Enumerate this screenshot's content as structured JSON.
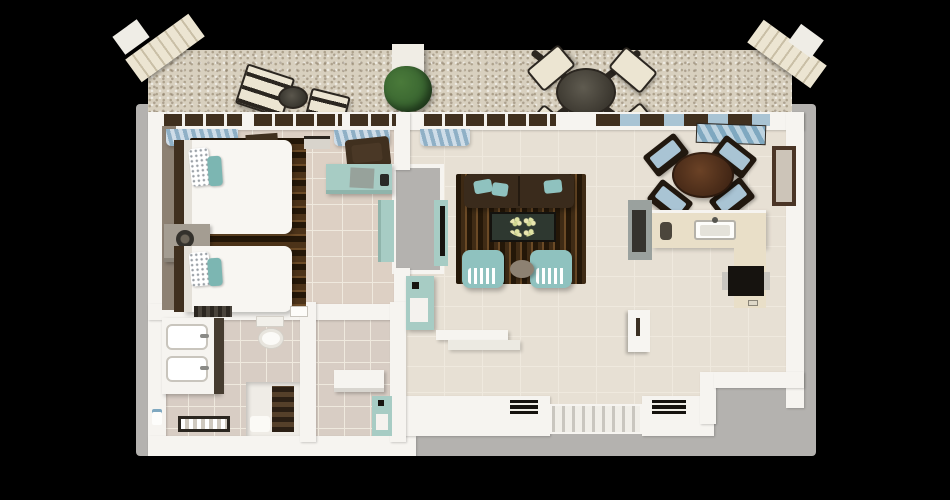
{
  "scene": {
    "title": "3D top-view floor plan render of a one-bedroom apartment with balcony",
    "view": "top-down 3d render",
    "background": "black"
  },
  "colors": {
    "background": "#000000",
    "exterior_concrete": "#b4b2af",
    "balcony_pebble": "#d8d0bf",
    "wall": "#f6f4f0",
    "floor_tile": "#e7e0d4",
    "floor_grout": "#efe9de",
    "bedroom_floor": "#ddd0c4",
    "bath_floor": "#d8cdc4",
    "taupe_wall": "#8d8173",
    "rug_dark": "#241708",
    "rug_mid": "#4c3319",
    "rug_light": "#6b4a26",
    "sofa_brown": "#3a2b1c",
    "teal": "#8fc2bf",
    "teal_deep": "#7cb6b2",
    "mint": "#a7ccc4",
    "wood_dark": "#40301f",
    "walnut": "#6b4226",
    "glass_blue": "#a9c4d4",
    "curtain_blue": "#8fb0c6",
    "curtain_light": "#cfdde8",
    "cream": "#ece5d2",
    "frame_black": "#2b2620",
    "plant_green": "#35602e",
    "counter_beige": "#e9dfc8",
    "steel_grey": "#9aa19e",
    "marble_green": "#2e3830",
    "white": "#f8f6f2"
  },
  "rooms": [
    {
      "name": "balcony",
      "furniture": [
        "two sun loungers",
        "round side table",
        "potted plant",
        "white pillar",
        "outdoor dining table with four cream chairs",
        "corner awnings"
      ]
    },
    {
      "name": "bedroom",
      "furniture": [
        "two beds with white duvets and teal pillows",
        "dark wood headboards",
        "striped dark-brown area rug",
        "nightstand with lamp",
        "mint writing desk",
        "dark desk chair",
        "mint wardrobe",
        "blue window curtains"
      ]
    },
    {
      "name": "bathroom",
      "furniture": [
        "double vanity with two sinks",
        "toilet",
        "walk-in shower with drain grate",
        "linen closet with dark shelves",
        "towel",
        "bench",
        "mint utility cabinet"
      ]
    },
    {
      "name": "living-room",
      "furniture": [
        "dark brown sofa with teal cushions",
        "striped dark-brown rug",
        "green-marble coffee table with flowers",
        "two teal armchairs",
        "round ottoman",
        "tv cabinet",
        "mint minibar cabinet",
        "hall console shelves"
      ]
    },
    {
      "name": "dining-area",
      "furniture": [
        "round walnut dining table",
        "four dark chairs with light-blue seats",
        "wall mirror"
      ]
    },
    {
      "name": "kitchen",
      "furniture": [
        "beige counter with sink and faucet",
        "tall grey cabinet",
        "black cooktop/oven",
        "open white door"
      ]
    },
    {
      "name": "hallway",
      "furniture": [
        "striped entry doormat",
        "two black floor plates by the entrance"
      ]
    }
  ]
}
